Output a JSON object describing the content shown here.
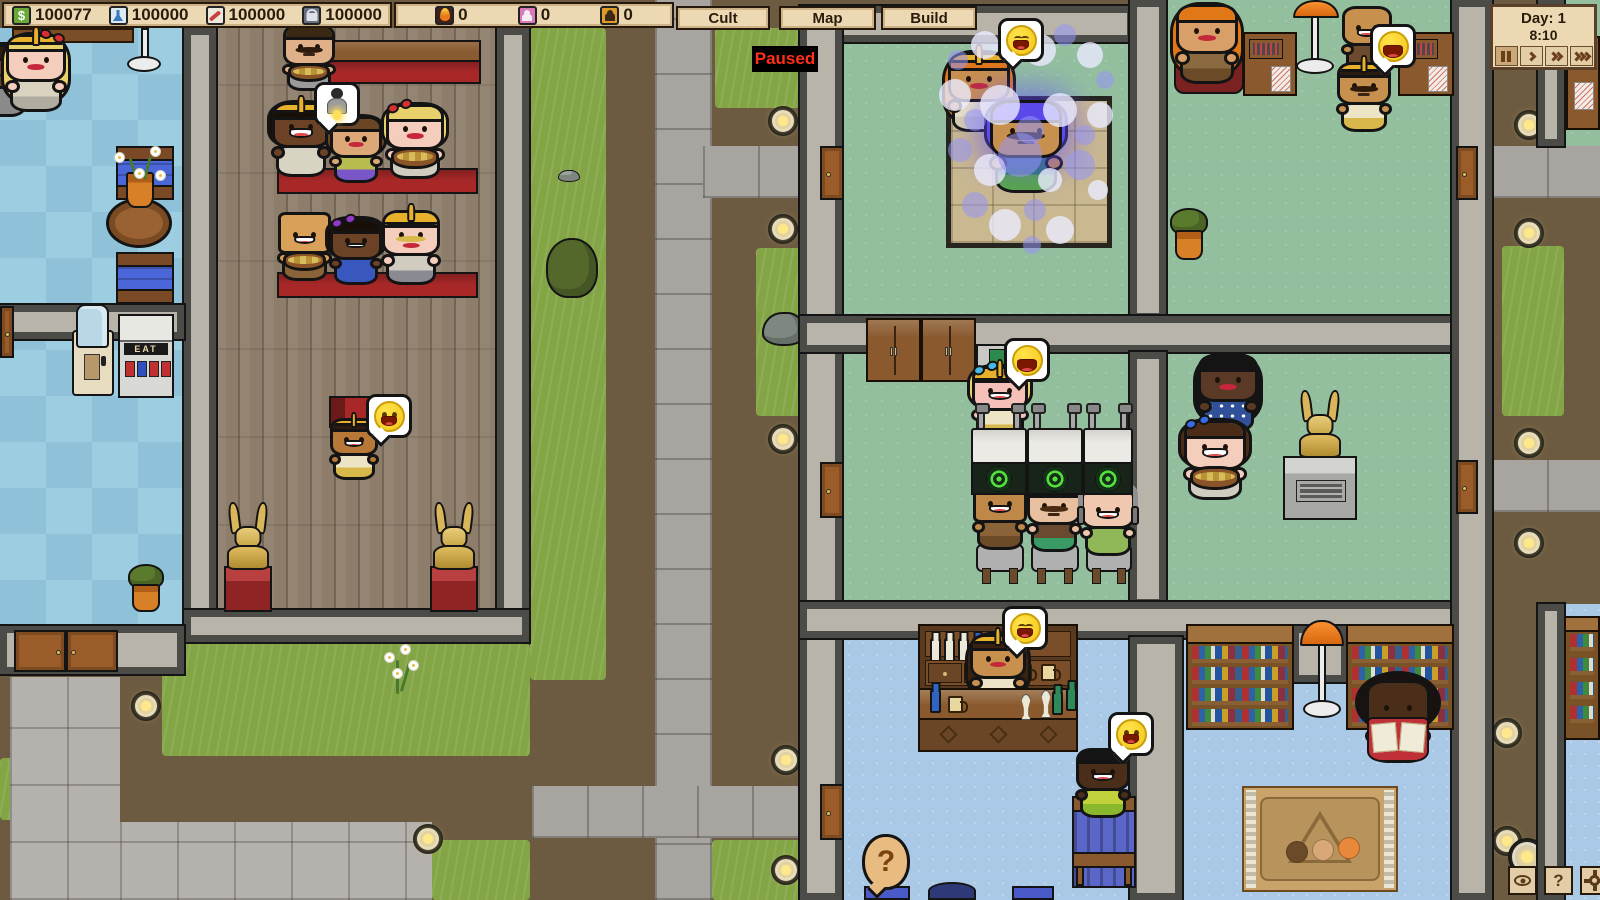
{
  "hud": {
    "resources": [
      {
        "icon": "money-icon",
        "value": "100077"
      },
      {
        "icon": "research-icon",
        "value": "100000"
      },
      {
        "icon": "influence-icon",
        "value": "100000"
      },
      {
        "icon": "security-icon",
        "value": "100000"
      }
    ],
    "meters": [
      {
        "icon": "heat-icon",
        "value": "0"
      },
      {
        "icon": "speaker-icon",
        "value": "0"
      },
      {
        "icon": "cultist-icon",
        "value": "0"
      }
    ],
    "menu_buttons": [
      "Cult",
      "Map",
      "Build"
    ],
    "paused_label": "Paused",
    "clock_day": "Day: 1",
    "clock_time": "8:10",
    "help_label": "?"
  },
  "labels": {
    "vending": "EAT",
    "money_symbol": "$",
    "question_mark": "?"
  },
  "scene": {
    "people": [
      {
        "id": "edge-follower",
        "x": -26,
        "y": 44,
        "w": 56,
        "skin": "#6b4226",
        "hair": "#2e1c0e",
        "hairStyle": "bob",
        "shirt": "#8a8a8a",
        "mouth": "flat"
      },
      {
        "id": "lobby-priestess",
        "x": 6,
        "y": 34,
        "w": 60,
        "skin": "#f5cdbd",
        "hair": "#e8d06a",
        "hairStyle": "long",
        "hat": "crown",
        "bow": "#d83030",
        "bowPos": "right",
        "mouth": "lips",
        "shirt": "#d8d2be",
        "shirt2": "#b0aca0"
      },
      {
        "id": "pew-man-mustache",
        "x": 283,
        "y": 24,
        "w": 52,
        "skin": "#e0b088",
        "hair": "#3a2814",
        "hairStyle": "short",
        "mustache": "#2e1a0c",
        "mouth": "flat",
        "shirt": "#9a9a9a",
        "prop": "basket"
      },
      {
        "id": "pew-woman-crowned",
        "x": 272,
        "y": 102,
        "w": 58,
        "skin": "#6b4226",
        "hair": "#181008",
        "hairStyle": "bob",
        "hat": "crown",
        "mouth": "open",
        "shirt": "#d8d4c4"
      },
      {
        "id": "pew-woman-brown",
        "x": 330,
        "y": 116,
        "w": 52,
        "skin": "#dca878",
        "hair": "#6b4626",
        "hairStyle": "bob",
        "mouth": "lips",
        "shirt": "#b8bc4e",
        "shirt2": "#7a56c8"
      },
      {
        "id": "pew-woman-blonde",
        "x": 386,
        "y": 104,
        "w": 58,
        "skin": "#f5cdbd",
        "hair": "#e8d06a",
        "hairStyle": "bob",
        "bow": "#d83030",
        "mouth": "lips",
        "shirt": "#d0ccc0",
        "prop": "basket"
      },
      {
        "id": "pew-man-square",
        "x": 278,
        "y": 212,
        "w": 53,
        "skin": "#d8a058",
        "hairStyle": "none",
        "sq": true,
        "mouth": "open",
        "shirt": "#8a6438",
        "prop": "basket"
      },
      {
        "id": "pew-woman-bow",
        "x": 330,
        "y": 218,
        "w": 52,
        "skin": "#6b4226",
        "hair": "#181008",
        "hairStyle": "bob",
        "bow": "#9038c8",
        "mouth": "smile",
        "shirt": "#3858c0"
      },
      {
        "id": "pew-man-helmet",
        "x": 382,
        "y": 210,
        "w": 58,
        "skin": "#f5cdbd",
        "hair": "#e8d06a",
        "hairStyle": "short",
        "hat": "helm",
        "mustache": "#d8b84a",
        "mouth": "lips",
        "shirt": "#d0ccc0",
        "shirt2": "#8a8a92"
      },
      {
        "id": "preacher",
        "x": 330,
        "y": 418,
        "w": 48,
        "skin": "#b87838",
        "hair": "#2e1a0e",
        "hairStyle": "short",
        "hat": "crown",
        "mouth": "open",
        "shirt": "#ece4c4",
        "shirt2": "#d8b84a"
      },
      {
        "id": "bath-attendant",
        "x": 948,
        "y": 52,
        "w": 62,
        "skin": "#c8904e",
        "hair": "#e07818",
        "hairStyle": "long",
        "hat": "crown",
        "mouth": "lips",
        "shirt": "#ece4c4",
        "shirt2": "#d8d0b0"
      },
      {
        "id": "bath-convert",
        "x": 990,
        "y": 100,
        "w": 72,
        "skin": "#c8904e",
        "hair": "#5a48e8",
        "hairStyle": "bob",
        "aura": true,
        "mustache": "#2e1a0c",
        "mouth": "flat",
        "shirt": "#2a7a6a",
        "shirt2": "#58a848"
      },
      {
        "id": "salon-operator",
        "x": 972,
        "y": 366,
        "w": 56,
        "skin": "#f5c0b8",
        "hair": "#e8d06a",
        "hairStyle": "bob",
        "hat": "helm",
        "bow": "#48b8e8",
        "mouth": "open",
        "shirt": "#ece4c4",
        "shirt2": "#d8b84a"
      },
      {
        "id": "salon-client-1",
        "x": 973,
        "y": 480,
        "w": 54,
        "skin": "#c08848",
        "hairStyle": "none",
        "sq": true,
        "mouth": "open",
        "shirt": "#8a6438",
        "shirt2": "#6b4a28"
      },
      {
        "id": "salon-client-2",
        "x": 1027,
        "y": 482,
        "w": 54,
        "skin": "#e8c0a0",
        "hair": "#5a3a20",
        "hairStyle": "short",
        "mustache": "#4a2c14",
        "mouth": "flat",
        "shirt": "#6b4830",
        "shirt2": "#3a9a66"
      },
      {
        "id": "salon-client-3",
        "x": 1081,
        "y": 486,
        "w": 54,
        "skin": "#f0c8b0",
        "hairStyle": "bald",
        "headphones": true,
        "mouth": "open",
        "shirt": "#90b858"
      },
      {
        "id": "statue-viewer-1",
        "x": 1198,
        "y": 354,
        "w": 60,
        "skin": "#5a3a26",
        "hair": "#141414",
        "hairStyle": "long",
        "mouth": "lips",
        "shirt": "#30509a",
        "dots": true
      },
      {
        "id": "statue-viewer-2",
        "x": 1184,
        "y": 420,
        "w": 62,
        "skin": "#f5cdbd",
        "hair": "#4a2c18",
        "hairStyle": "bob",
        "bow": "#3a6ae8",
        "mouth": "open",
        "shirt": "#d0ccc0",
        "prop": "basket"
      },
      {
        "id": "desk-woman",
        "x": 1176,
        "y": 4,
        "w": 62,
        "skin": "#d8a068",
        "hair": "#e07818",
        "hairStyle": "long",
        "mouth": "lips",
        "shirt": "#8a6840",
        "shirt2": "#6b4a28"
      },
      {
        "id": "laughing-man",
        "x": 1342,
        "y": 6,
        "w": 50,
        "skin": "#c8904e",
        "hairStyle": "bald",
        "mouth": "open",
        "shirt": "#6b4a2e"
      },
      {
        "id": "crowned-man",
        "x": 1337,
        "y": 62,
        "w": 54,
        "skin": "#c8904e",
        "hair": "#2a1a10",
        "hairStyle": "short",
        "hat": "crown",
        "mustache": "#2e1a0c",
        "mouth": "flat",
        "shirt": "#ece4c4",
        "shirt2": "#d8b84a"
      },
      {
        "id": "bartender",
        "x": 970,
        "y": 634,
        "w": 56,
        "skin": "#c8904e",
        "hair": "#3a2212",
        "hairStyle": "long",
        "hat": "crown",
        "mouth": "lips",
        "shirt": "#ece4c4"
      },
      {
        "id": "bar-patron",
        "x": 1076,
        "y": 748,
        "w": 54,
        "skin": "#4a2e1a",
        "hair": "#141414",
        "hairStyle": "short",
        "mouth": "open",
        "shirt": "#c2d23c",
        "shirt2": "#8ab82c"
      },
      {
        "id": "reader",
        "x": 1366,
        "y": 680,
        "w": 64,
        "skin": "#4a2e1a",
        "hair": "#181210",
        "hairStyle": "afro",
        "mouth": "none",
        "shirt": "#7a2040",
        "prop": "book"
      }
    ],
    "emotes": [
      {
        "x": 314,
        "y": 82,
        "type": "figure"
      },
      {
        "x": 366,
        "y": 394,
        "type": "smile"
      },
      {
        "x": 998,
        "y": 18,
        "type": "joy"
      },
      {
        "x": 1004,
        "y": 338,
        "type": "laugh"
      },
      {
        "x": 1370,
        "y": 24,
        "type": "laugh"
      },
      {
        "x": 1002,
        "y": 606,
        "type": "joy"
      },
      {
        "x": 1108,
        "y": 712,
        "type": "smile"
      },
      {
        "x": 862,
        "y": 834,
        "type": "question"
      }
    ],
    "ground_lights": [
      {
        "x": 131,
        "y": 691
      },
      {
        "x": 413,
        "y": 824
      },
      {
        "x": 768,
        "y": 106
      },
      {
        "x": 768,
        "y": 214
      },
      {
        "x": 768,
        "y": 424
      },
      {
        "x": 771,
        "y": 745
      },
      {
        "x": 771,
        "y": 855
      },
      {
        "x": 1514,
        "y": 110
      },
      {
        "x": 1514,
        "y": 218
      },
      {
        "x": 1514,
        "y": 428
      },
      {
        "x": 1514,
        "y": 528
      },
      {
        "x": 1492,
        "y": 718
      },
      {
        "x": 1492,
        "y": 826
      },
      {
        "x": 1508,
        "y": 838,
        "s": 38
      }
    ],
    "bath_bubbles": [
      [
        958,
        60,
        10
      ],
      [
        985,
        45,
        14
      ],
      [
        1012,
        38,
        9
      ],
      [
        1040,
        50,
        16
      ],
      [
        1065,
        35,
        11
      ],
      [
        1090,
        55,
        13
      ],
      [
        1105,
        80,
        9
      ],
      [
        955,
        95,
        16
      ],
      [
        975,
        120,
        11
      ],
      [
        1000,
        105,
        20
      ],
      [
        1030,
        130,
        14
      ],
      [
        1060,
        110,
        17
      ],
      [
        1085,
        135,
        10
      ],
      [
        1100,
        115,
        13
      ],
      [
        960,
        150,
        12
      ],
      [
        990,
        170,
        16
      ],
      [
        1020,
        155,
        22
      ],
      [
        1050,
        180,
        12
      ],
      [
        1080,
        165,
        15
      ],
      [
        1098,
        190,
        10
      ],
      [
        975,
        205,
        13
      ],
      [
        1005,
        225,
        16
      ],
      [
        1035,
        210,
        11
      ],
      [
        1060,
        230,
        14
      ],
      [
        1032,
        245,
        9
      ]
    ],
    "bar_shelf_bottles": [
      "#ece8da",
      "#ece8da",
      "#ece8da",
      "#3064c0",
      "#2e8a5a",
      "#2e8a5a"
    ],
    "bar_mug_count": 3
  }
}
